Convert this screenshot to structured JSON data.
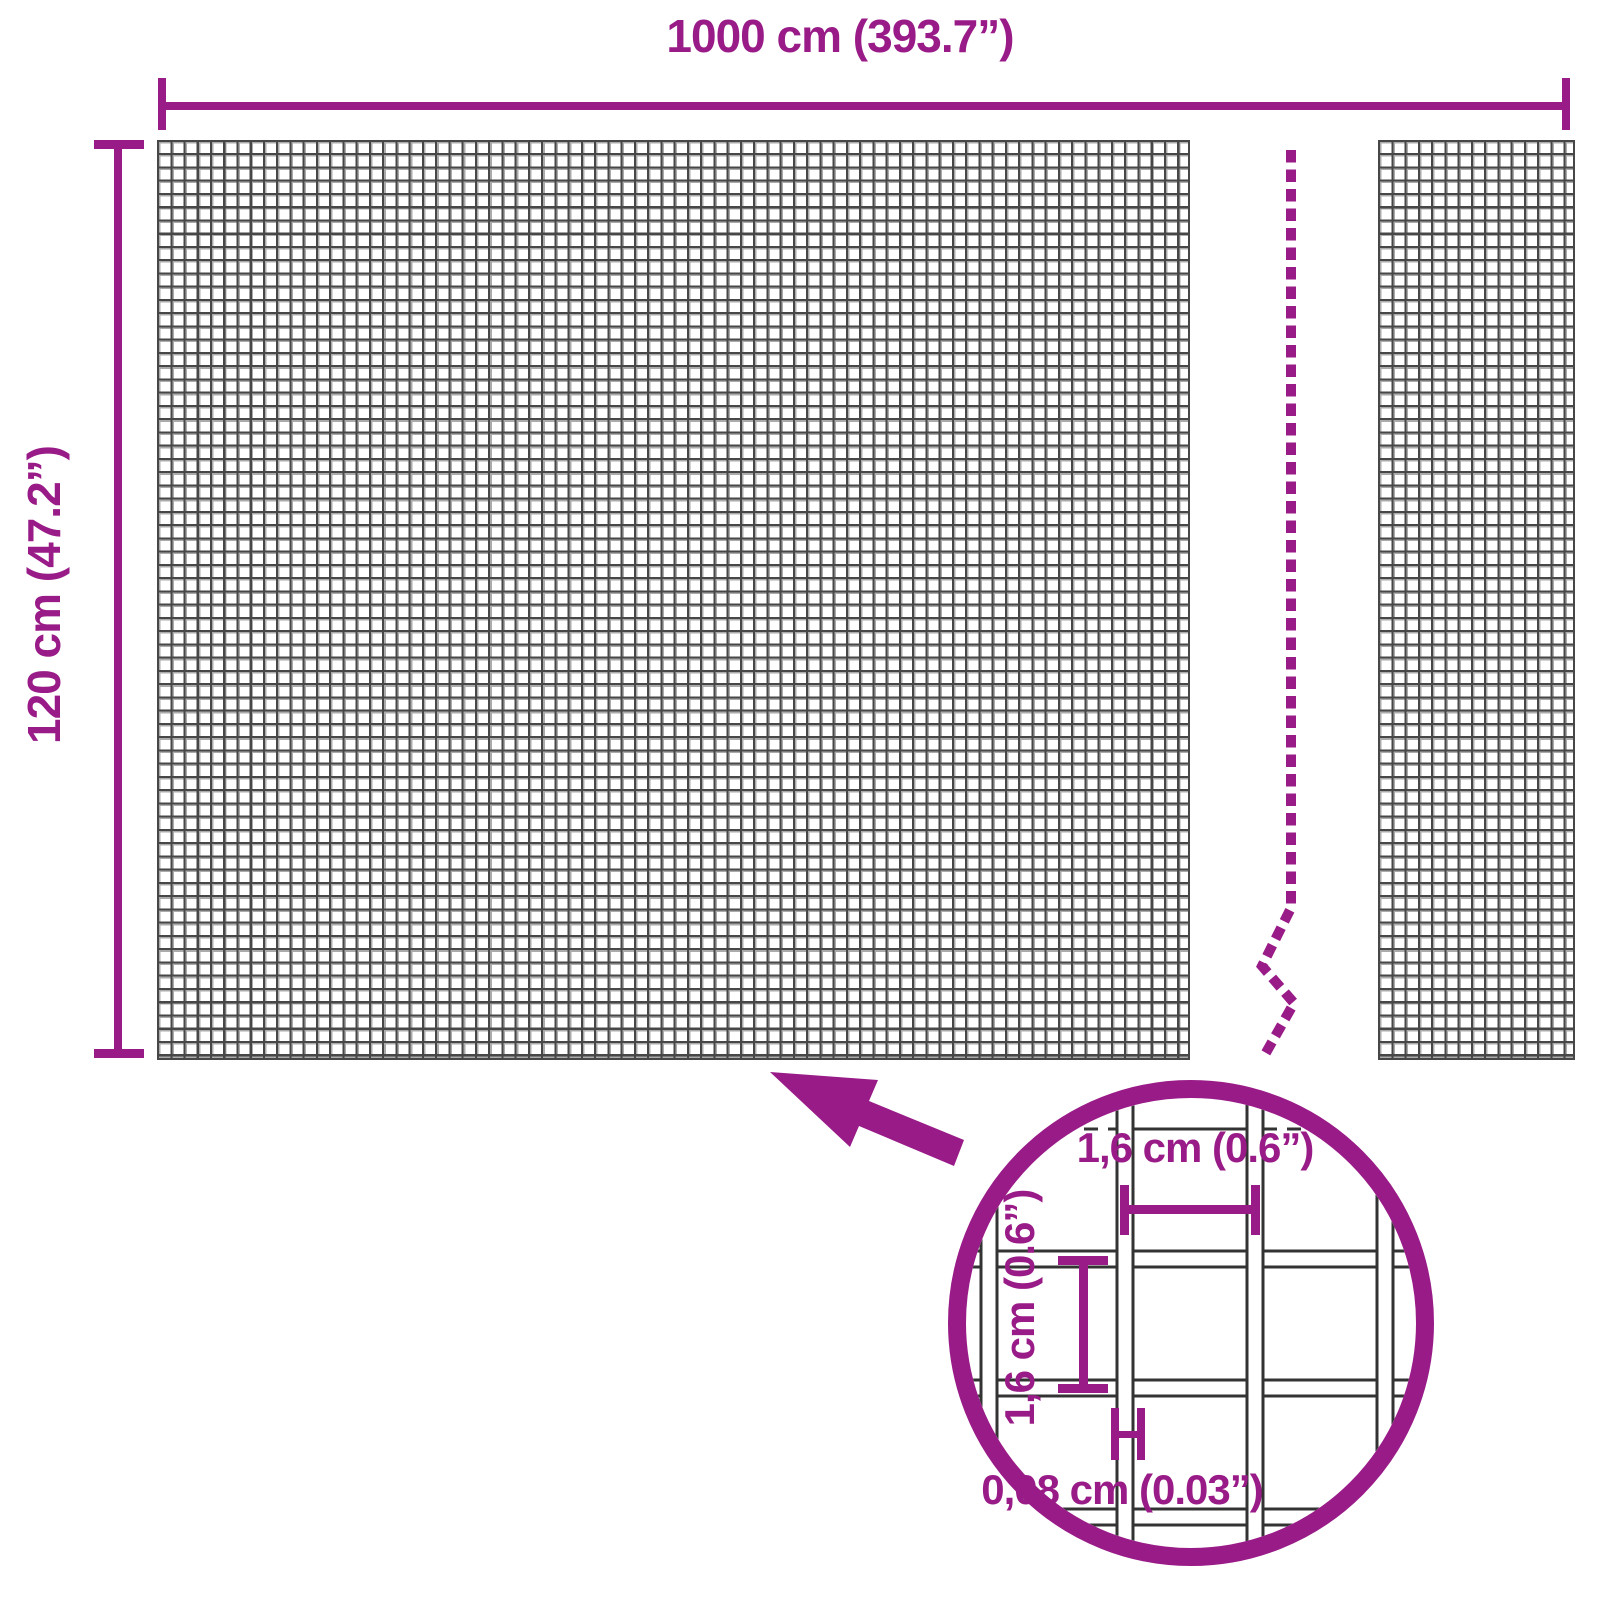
{
  "colors": {
    "accent": "#991b87",
    "mesh_wire_grid": "#474747",
    "detail_wire_outline": "#333333"
  },
  "outer_dimensions": {
    "width_label": "1000 cm (393.7”)",
    "height_label": "120 cm (47.2”)"
  },
  "detail_view": {
    "mesh_width_label": "1,6 cm (0.6”)",
    "mesh_height_label": "1,6 cm (0.6”)",
    "wire_thickness_label": "0,08 cm (0.03”)"
  },
  "icons": {
    "arrow": "zoom-arrow-icon",
    "magnifier": "magnifier-circle",
    "break_line": "panel-break-dashed-line"
  }
}
